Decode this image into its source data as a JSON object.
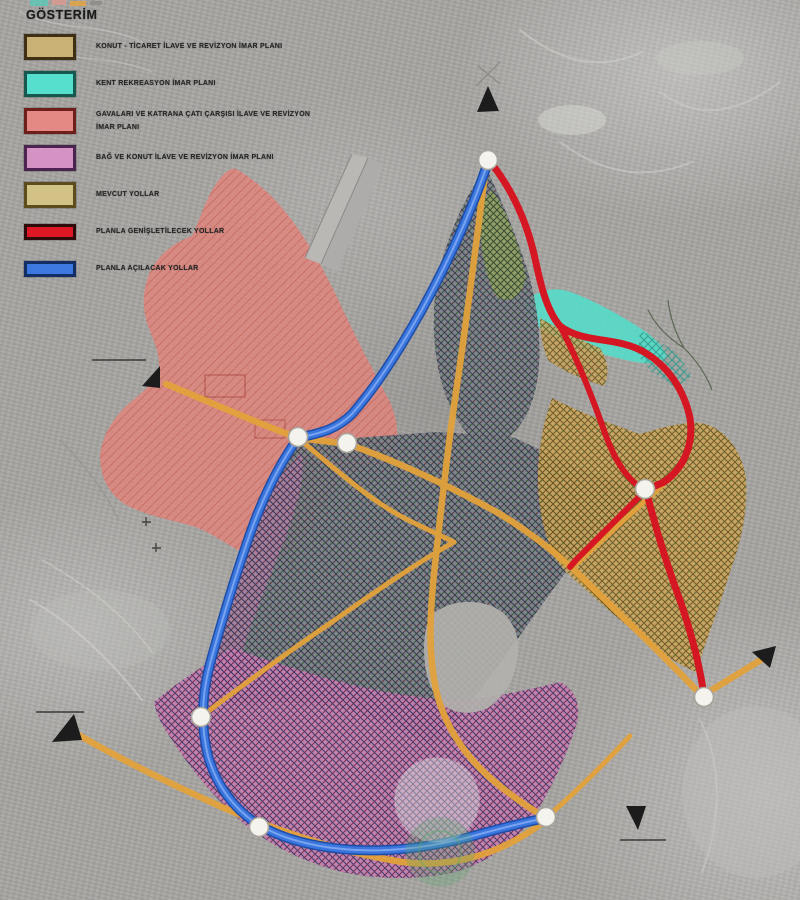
{
  "legend": {
    "title": "GÖSTERİM",
    "items": [
      {
        "label": "KONUT - TİCARET İLAVE VE REVİZYON İMAR PLANI",
        "color": "#c9b176",
        "border": "#3f2f14",
        "kind": "zone-hatch"
      },
      {
        "label": "KENT REKREASYON İMAR PLANI",
        "color": "#57dfcd",
        "border": "#17584e",
        "kind": "zone"
      },
      {
        "label": "GAVALARI VE KATRANA ÇATI ÇARŞISI İLAVE VE REVİZYON İMAR PLANI",
        "color": "#e48983",
        "border": "#6e1f1c",
        "kind": "zone"
      },
      {
        "label": "BAĞ VE KONUT İLAVE VE REVİZYON İMAR PLANI",
        "color": "#d493c3",
        "border": "#4c2450",
        "kind": "zone"
      },
      {
        "label": "MEVCUT YOLLAR",
        "color": "#d2c285",
        "border": "#5e4d1c",
        "kind": "zone-hatch"
      },
      {
        "label": "PLANLA GENİŞLETİLECEK YOLLAR",
        "color": "#dd1723",
        "border": "#2e0a0a",
        "kind": "road"
      },
      {
        "label": "PLANLA AÇILACAK YOLLAR",
        "color": "#3c78e0",
        "border": "#122e64",
        "kind": "road"
      }
    ]
  },
  "map": {
    "colors": {
      "zone_salmon": "#e2837a",
      "zone_teal": "#56dcc9",
      "zone_tan_base": "#c9a55e",
      "zone_pink_base": "#c57fae",
      "zone_green_base": "#93a35e",
      "fabric_base": "#7e828a",
      "fabric_line": "#2e3846",
      "road_existing": "#e3a23b",
      "road_widened": "#d41722",
      "road_new": "#3a76de",
      "road_new_casing": "#1d4da9",
      "road_new_core": "#7fa8ef",
      "junction_fill": "#f5f3ee",
      "junction_ring": "#a9a49c",
      "arrow": "#1c1c1c",
      "watermark_green": "#59a86c",
      "watermark_halo": "#dcebe9",
      "runway_gray": "#b9b8b5"
    }
  }
}
